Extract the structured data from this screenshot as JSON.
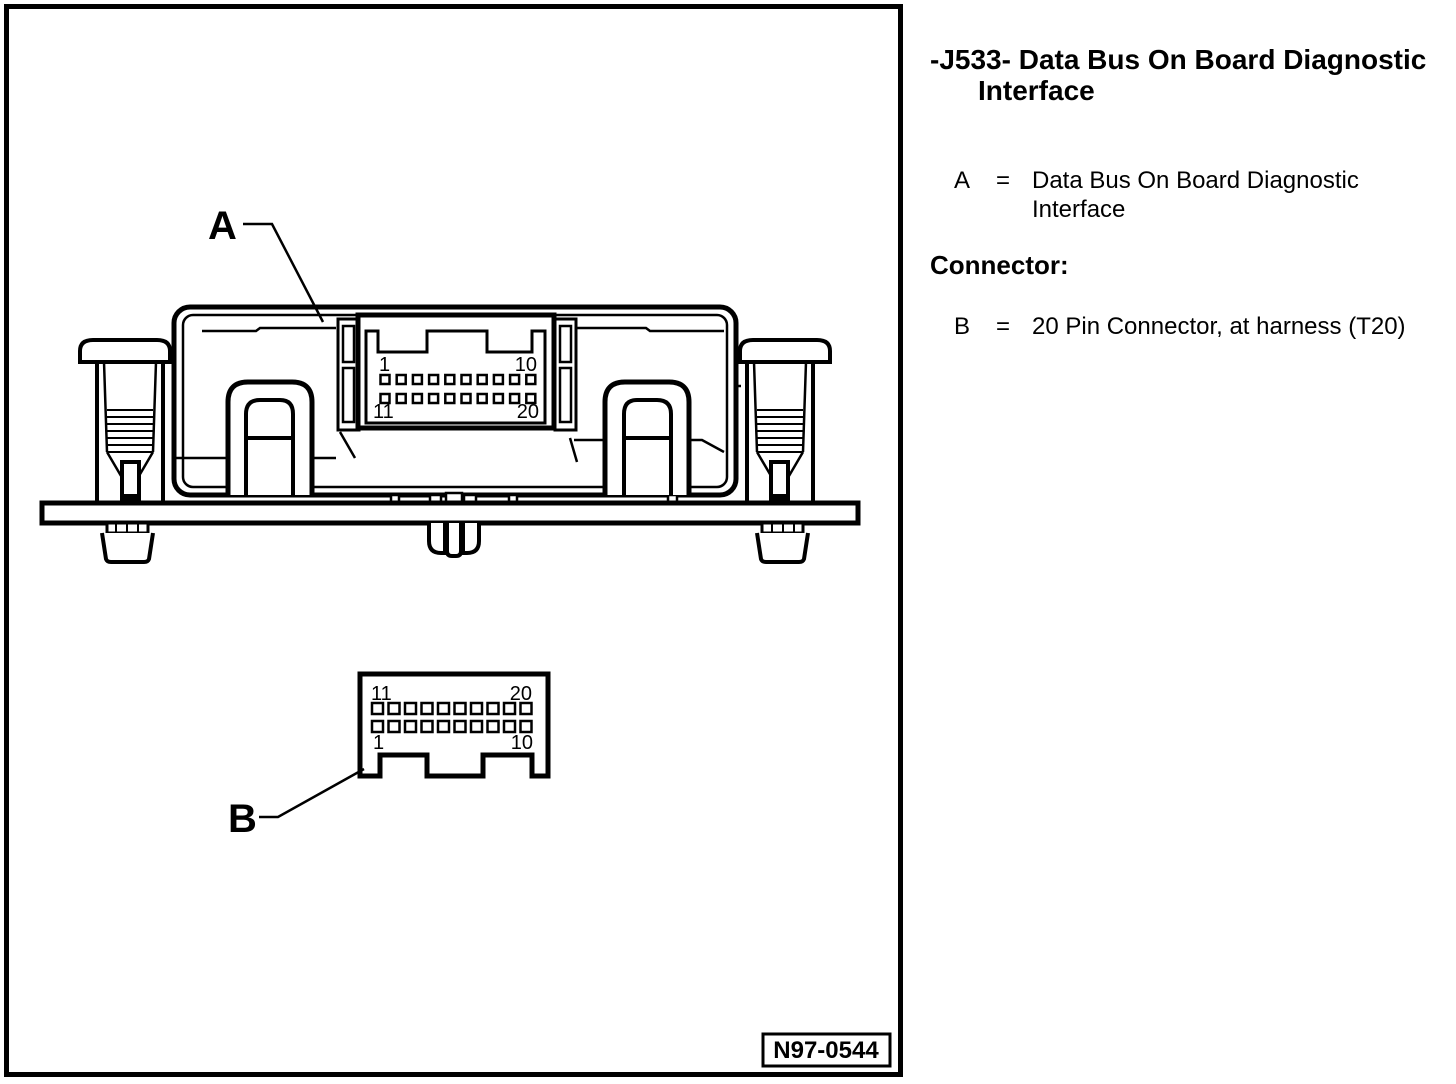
{
  "legend": {
    "title": "-J533- Data Bus On Board Diagnostic\nInterface",
    "items": [
      {
        "key": "A",
        "eq": "=",
        "desc": "Data Bus On Board Diagnostic\nInterface"
      }
    ],
    "section_heading": "Connector:",
    "section_items": [
      {
        "key": "B",
        "eq": "=",
        "desc": "20 Pin Connector, at harness (T20)"
      }
    ]
  },
  "figure": {
    "drawing_number": "N97-0544",
    "callouts": {
      "module": "A",
      "harness_connector": "B"
    },
    "module_socket": {
      "rows": 2,
      "pins_per_row": 10,
      "pin_labels": {
        "top_left": "1",
        "top_right": "10",
        "bottom_left": "11",
        "bottom_right": "20"
      }
    },
    "harness_connector": {
      "rows": 2,
      "pins_per_row": 10,
      "pin_labels": {
        "top_left": "11",
        "top_right": "20",
        "bottom_left": "1",
        "bottom_right": "10"
      }
    }
  }
}
